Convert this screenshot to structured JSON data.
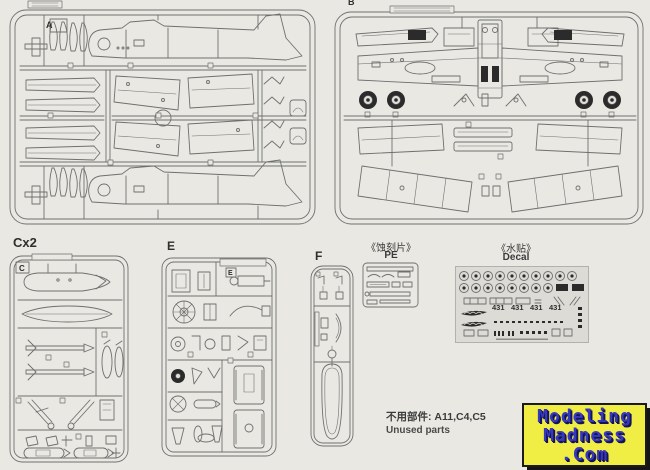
{
  "page": {
    "background": "#e9e8e3",
    "line_color": "#6f6f6f",
    "dark_color": "#2b2b2b"
  },
  "sprues": {
    "a": {
      "label": "A"
    },
    "b": {
      "label": "B"
    },
    "c": {
      "label": "Cx2",
      "corner": "C"
    },
    "e": {
      "label": "E",
      "corner": "E"
    },
    "f": {
      "label": "F"
    }
  },
  "pe": {
    "title_cn": "《蚀刻片》",
    "title_en": "PE"
  },
  "decal": {
    "title_cn": "《水贴》",
    "title_en": "Decal",
    "numbers": [
      "431",
      "431",
      "431",
      "431"
    ]
  },
  "unused": {
    "line1": "不用部件: A11,C4,C5",
    "line2": "Unused parts"
  },
  "logo": {
    "line1": "Modeling",
    "line2": "Madness",
    "line3": ".Com",
    "bg_color": "#f0ee45",
    "text_color": "#3838bd"
  }
}
